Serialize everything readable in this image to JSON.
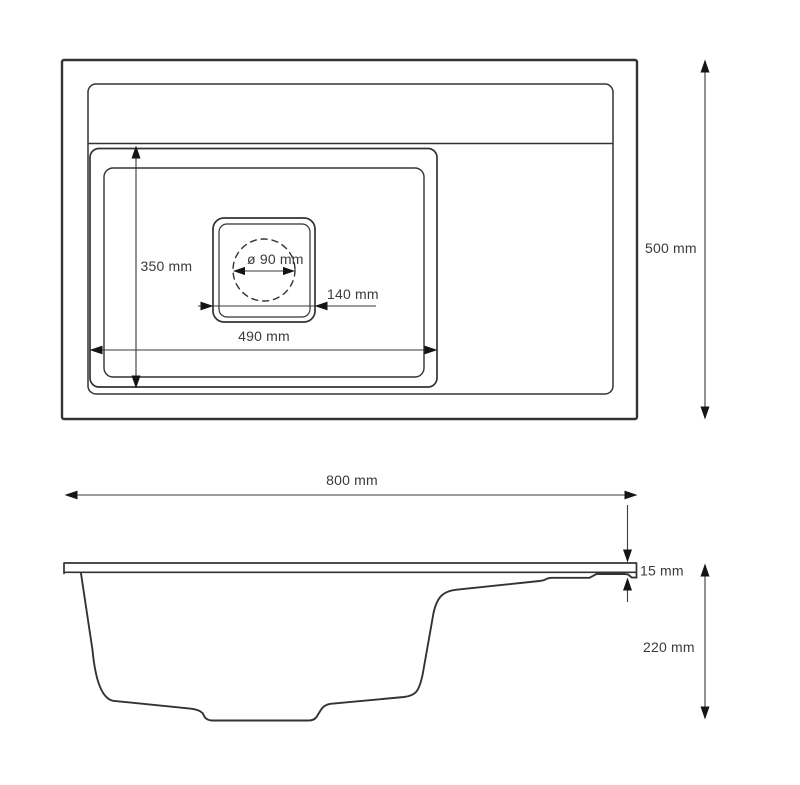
{
  "drawing": {
    "subject": "sink-technical-drawing",
    "colors": {
      "background": "#ffffff",
      "line": "#333333",
      "text": "#3a3a3a",
      "arrow": "#151515"
    },
    "top_view": {
      "height_label": "500 mm",
      "bowl_height_label": "350 mm",
      "bowl_width_label": "490 mm",
      "drain_width_label": "140 mm",
      "drain_diameter_label": "ø 90 mm"
    },
    "side_view": {
      "width_label": "800 mm",
      "rim_thickness_label": "15 mm",
      "depth_label": "220 mm"
    }
  }
}
